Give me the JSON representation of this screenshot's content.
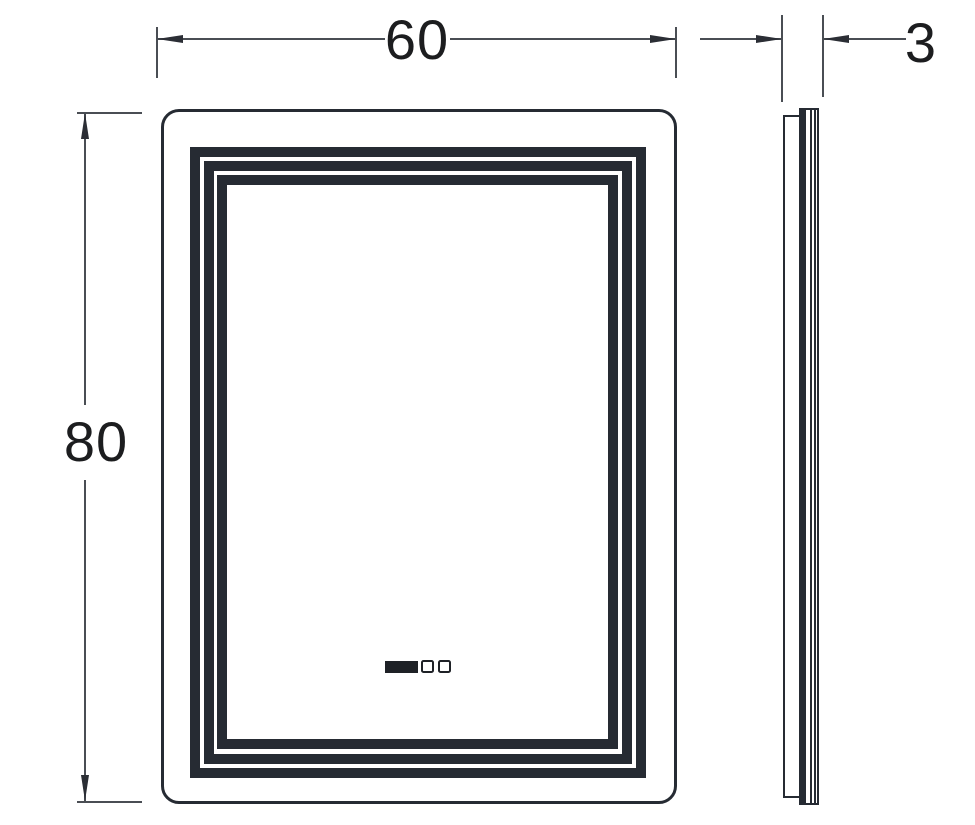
{
  "drawing": {
    "dimensions": {
      "width_label": "60",
      "height_label": "80",
      "depth_label": "3"
    },
    "colors": {
      "outline": "#262b33",
      "dimension_line": "#4a4e54",
      "arrowhead": "#2b2e35",
      "label_text": "#1c1d1f",
      "background": "#ffffff"
    },
    "icons": {
      "display_screen": "led-display-icon",
      "sensor_button": "touch-sensor-icon"
    }
  }
}
